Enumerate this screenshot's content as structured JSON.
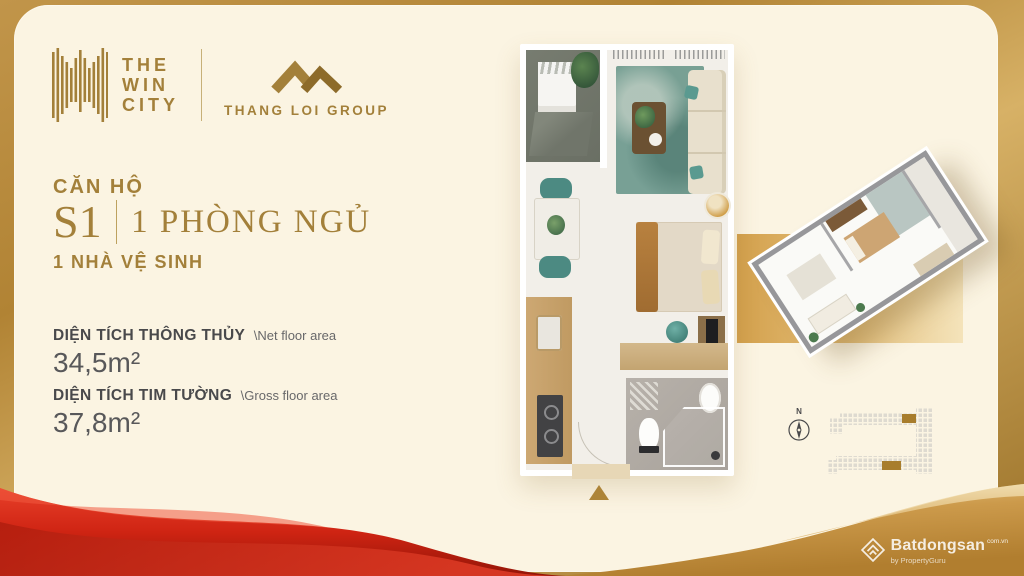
{
  "brand": {
    "win_city_lines": [
      "THE",
      "WIN",
      "CITY"
    ],
    "group_name": "THANG LOI GROUP"
  },
  "unit": {
    "label": "CĂN HỘ",
    "code": "S1",
    "bedrooms": "1 PHÒNG NGỦ",
    "bathrooms": "1 NHÀ VỆ SINH"
  },
  "areas": {
    "net_label": "DIỆN TÍCH THÔNG THỦY",
    "net_sub": "\\Net floor area",
    "net_value": "34,5m²",
    "gross_label": "DIỆN TÍCH TIM TƯỜNG",
    "gross_sub": "\\Gross floor area",
    "gross_value": "37,8m²"
  },
  "siteplan": {
    "north_label": "N"
  },
  "watermark": {
    "brand": "Batdongsan",
    "domain": "com.vn",
    "sub": "by PropertyGuru"
  },
  "colors": {
    "gold_accent": "#a3803a",
    "text_dark": "#4c4c4e",
    "cream": "#fbf4e2",
    "frame_gold": "#b18334",
    "ribbon_red": "#cf2c1d",
    "ribbon_gold": "#c9964a",
    "highlight_unit_gold": "#a87d2c"
  }
}
